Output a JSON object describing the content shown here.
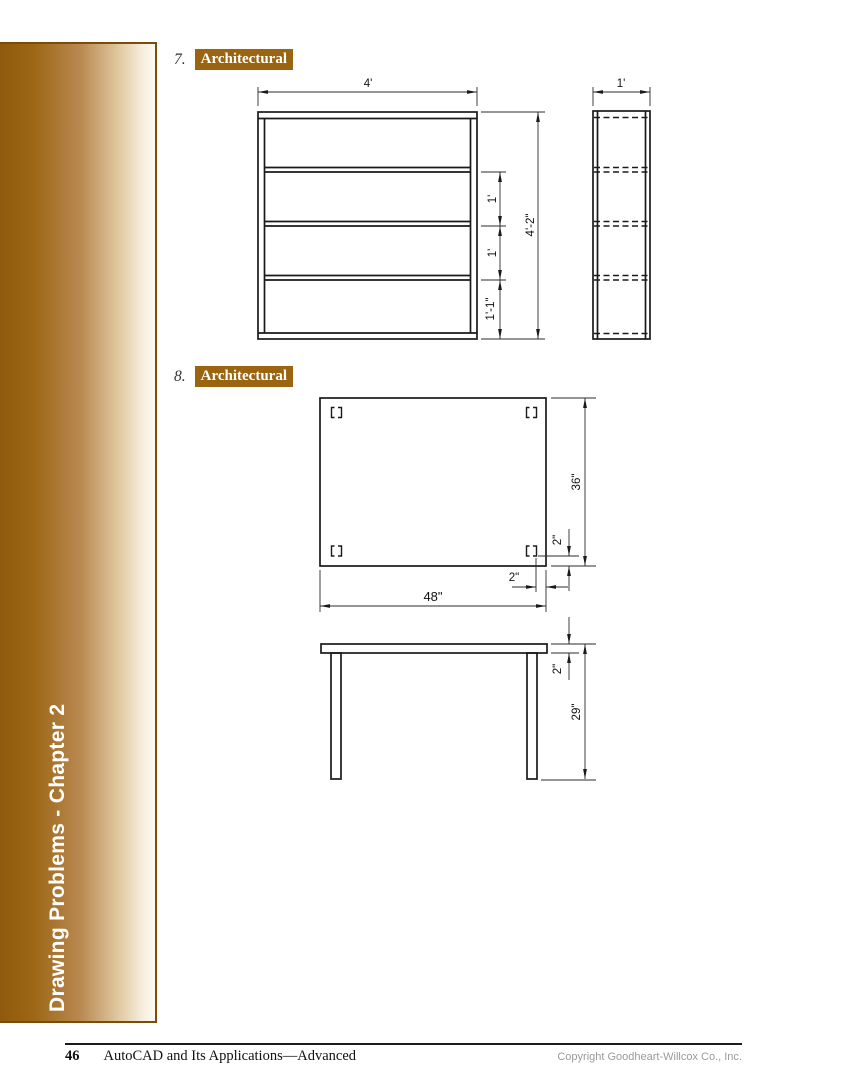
{
  "page": {
    "sidebar": {
      "text": "Drawing Problems - Chapter 2"
    },
    "footer": {
      "page_number": "46",
      "book_title": "AutoCAD and Its Applications—Advanced",
      "copyright": "Copyright Goodheart-Willcox Co., Inc."
    }
  },
  "problems": {
    "p7": {
      "number": "7.",
      "label": "Architectural"
    },
    "p8": {
      "number": "8.",
      "label": "Architectural"
    }
  },
  "colors": {
    "accent_brown": "#9a6410",
    "sidebar_border": "#7a4c06",
    "line_black": "#1a1a1a",
    "copyright_gray": "#9a9a9a"
  },
  "drawings": {
    "bookshelf": {
      "width_dim": "4'",
      "depth_dim": "1'",
      "shelf_space_dims": [
        "1'",
        "1'",
        "1'-1\""
      ],
      "height_dim": "4'-2\""
    },
    "table": {
      "top_depth_dim": "36\"",
      "leg_inset_bottom_dim": "2\"",
      "leg_inset_side_dim": "2\"",
      "top_width_dim": "48\"",
      "top_thickness_dim": "2\"",
      "height_dim": "29\""
    }
  }
}
